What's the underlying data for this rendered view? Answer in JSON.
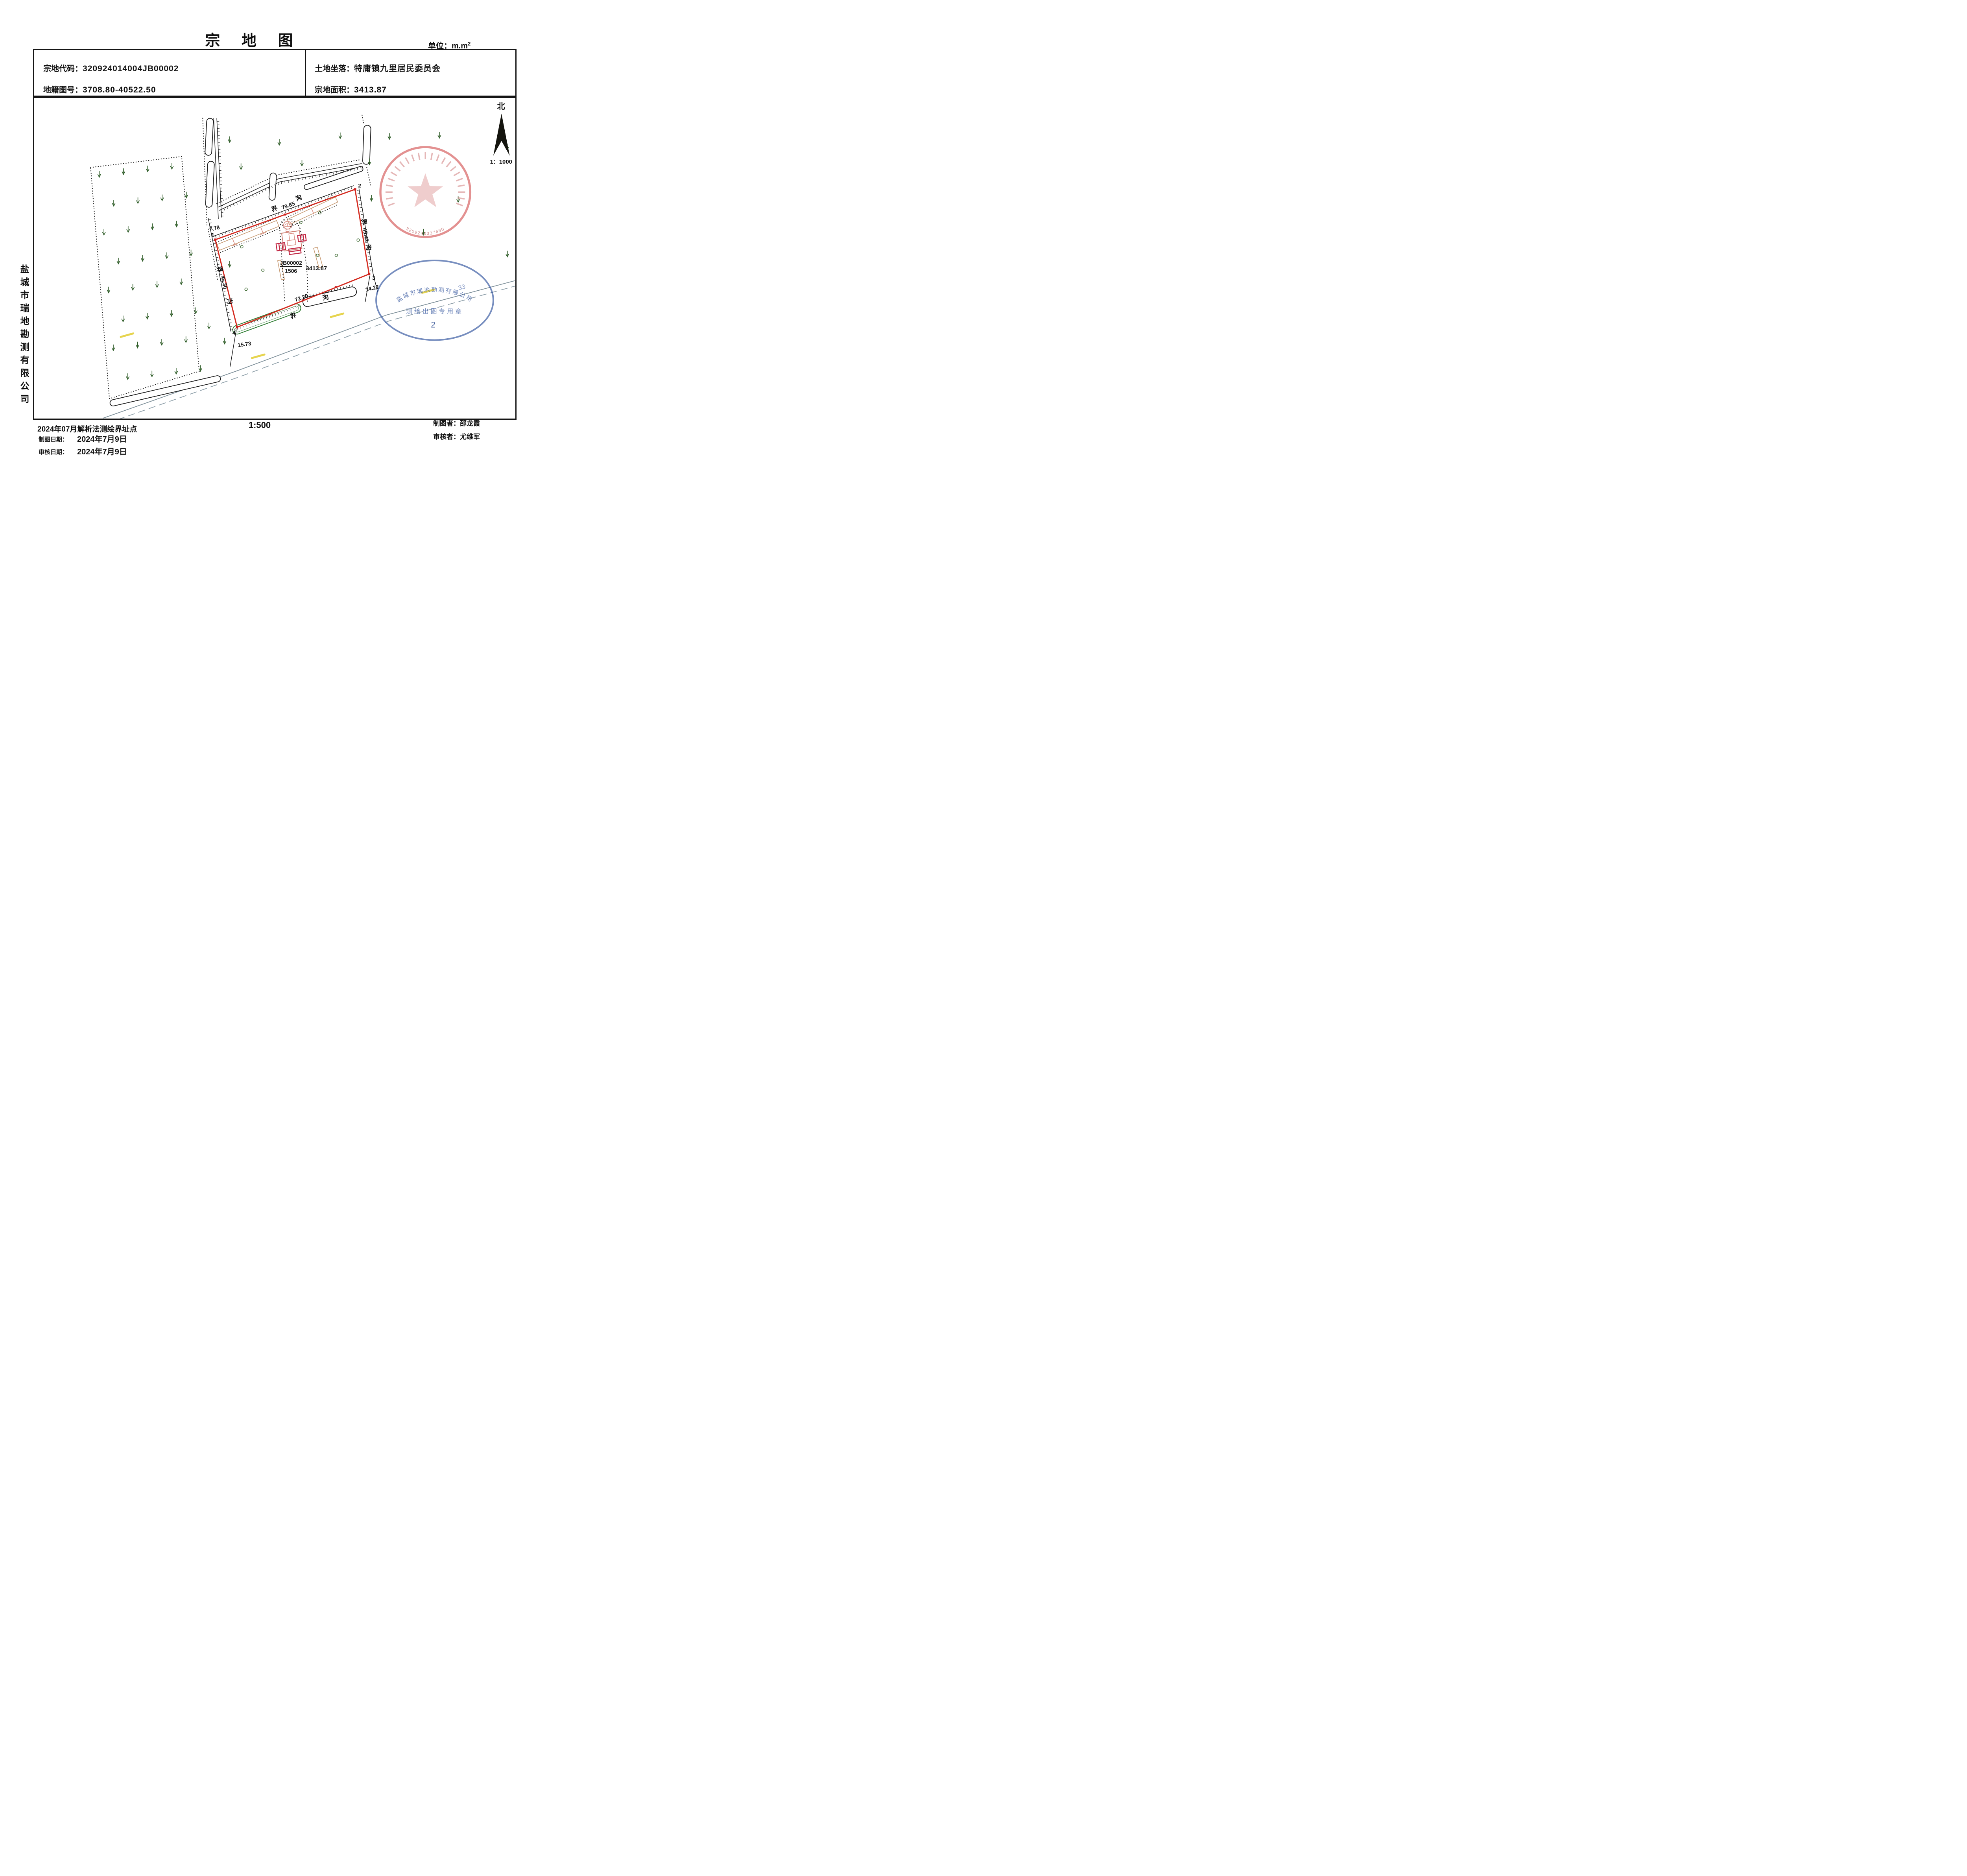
{
  "page": {
    "title": "宗 地 图",
    "unit_label": "单位：m.m",
    "unit_sup": "2"
  },
  "info": {
    "code_label": "宗地代码：",
    "code": "320924014004JB00002",
    "sheet_label": "地籍图号：",
    "sheet": "3708.80-40522.50",
    "location_label": "土地坐落：",
    "location": "特庸镇九里居民委员会",
    "area_label": "宗地面积：",
    "area": "3413.87"
  },
  "company": "盐城市瑞地勘测有限公司",
  "north": {
    "label": "北",
    "scale": "1：1000"
  },
  "parcel": {
    "v1": "1",
    "v2": "2",
    "v3": "3",
    "v4": "4",
    "code": "JB00002",
    "number": "1506",
    "area": "3413.87",
    "dim_top": "79.85",
    "dim_right": "45.43",
    "dim_left": "45.30",
    "dim_bottom": "72.20",
    "off_v1": "7.78",
    "off_v3": "14.22",
    "off_v4": "15.73",
    "jie": "界",
    "gou": "沟"
  },
  "stamps": {
    "red": {
      "digits": "3209240337690"
    },
    "blue": {
      "company": "盐城市瑞地勘测有限公司",
      "fragment": "33",
      "line": "测绘出图专用章",
      "number": "2"
    }
  },
  "footer": {
    "note": "2024年07月解析法测绘界址点",
    "scale": "1:500",
    "draw_date_label": "制图日期：",
    "draw_date": "2024年7月9日",
    "check_date_label": "审核日期：",
    "check_date": "2024年7月9日",
    "drafter_label": "制图者：",
    "drafter": "邵龙霞",
    "checker_label": "审核者：",
    "checker": "尤维军"
  }
}
